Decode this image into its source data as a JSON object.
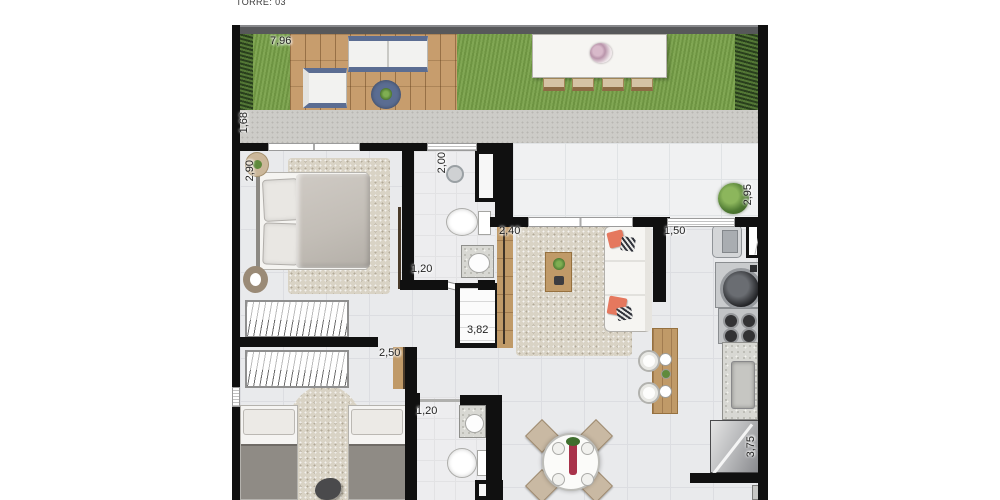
{
  "title": "TORRE: 03",
  "dimensions": {
    "garden": "7,96",
    "walkway": "1,68",
    "bedroom1": "2,90",
    "bath1_len": "2,00",
    "bath1_wid": "1,20",
    "entry": "2,40",
    "kitchen_win": "1,50",
    "terrace": "2,95",
    "hall": "3,82",
    "bedroom2": "2,50",
    "bath2": "1,20",
    "kitchen": "3,75"
  },
  "colors": {
    "grass": "#7aa24b",
    "hedge": "#3f612c",
    "deck_wood": "#c79d6d",
    "walkway": "#cdccc8",
    "wall": "#101010",
    "tile": "#e9eaec",
    "terrace_tile": "#f0f1f2",
    "rug": "#d9d3c5",
    "pillow_accent": "#e5785e",
    "outdoor_blue": "#5b6d92",
    "wood": "#c09a68",
    "label": "#1f1f1f"
  }
}
